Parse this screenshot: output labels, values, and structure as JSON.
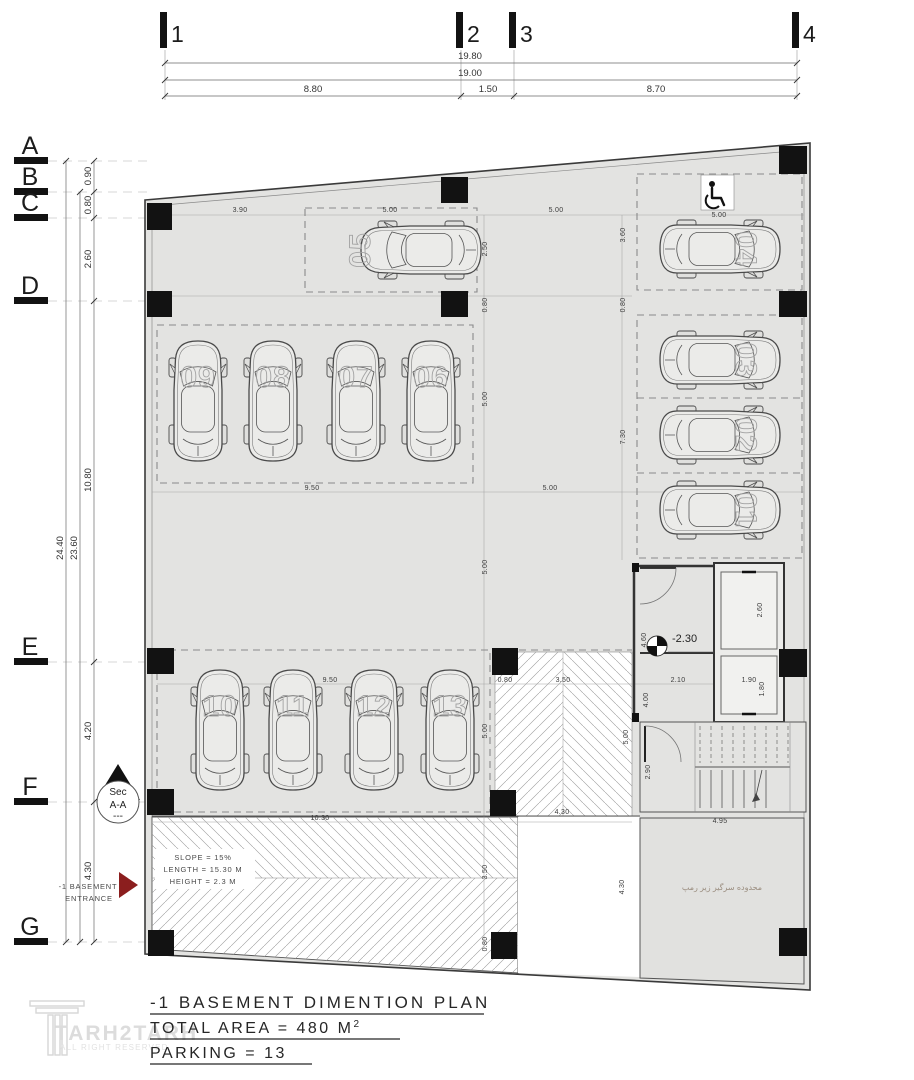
{
  "grid": {
    "columns": [
      "1",
      "2",
      "3",
      "4"
    ],
    "rows": [
      "A",
      "B",
      "C",
      "D",
      "E",
      "F",
      "G"
    ]
  },
  "top_ruler": {
    "overall": "19.80",
    "inner": "19.00",
    "segments": [
      "8.80",
      "1.50",
      "8.70"
    ]
  },
  "left_ruler": {
    "overall": "24.40",
    "inner": "23.60",
    "segments": [
      "0.90",
      "0.80",
      "2.60",
      "10.80",
      "4.20",
      "4.30"
    ]
  },
  "dims": [
    "3.90",
    "5.00",
    "5.00",
    "5.00",
    "2.50",
    "3.60",
    "0.80",
    "0.80",
    "5.00",
    "7.30",
    "9.50",
    "5.00",
    "5.00",
    "9.50",
    "0.80",
    "3.50",
    "2.10",
    "1.90",
    "5.00",
    "4.60",
    "2.60",
    "1.80",
    "4.00",
    "10.30",
    "4.30",
    "3.50",
    "0.80",
    "5.00",
    "2.90",
    "4.95",
    "4.30"
  ],
  "car_labels": {
    "c01": "01",
    "c02": "02",
    "c03": "03",
    "c04": "04",
    "c05": "05",
    "c06": "06",
    "c07": "07",
    "c08": "08",
    "c09": "09",
    "c10": "10",
    "c11": "11",
    "c12": "12",
    "c13": "13"
  },
  "level_marker": "-2.30",
  "ramp_note": {
    "slope": "SLOPE = 15%",
    "length": "LENGTH = 15.30 M",
    "height": "HEIGHT = 2.3 M"
  },
  "entrance": {
    "line1": "-1 BASEMENT",
    "line2": "ENTRANCE"
  },
  "section_marker": {
    "line1": "Sec",
    "line2": "A-A",
    "line3": "---"
  },
  "under_ramp_label": "محدوده سرگیر زیر رمپ",
  "title_block": {
    "line1": "-1 BASEMENT DIMENTION PLAN",
    "line2": "TOTAL AREA = 480 M",
    "line2_sup": "2",
    "line3": "PARKING = 13"
  },
  "logo": {
    "name": "TARH2TARH",
    "tagline": "ALL RIGHT RESERVED"
  },
  "colors": {
    "floor": "#e3e3e1",
    "column": "#121212",
    "entrance_arrow": "#8b1e1e",
    "hatch": "#9a9a9a",
    "wall": "#3a3a3a"
  }
}
